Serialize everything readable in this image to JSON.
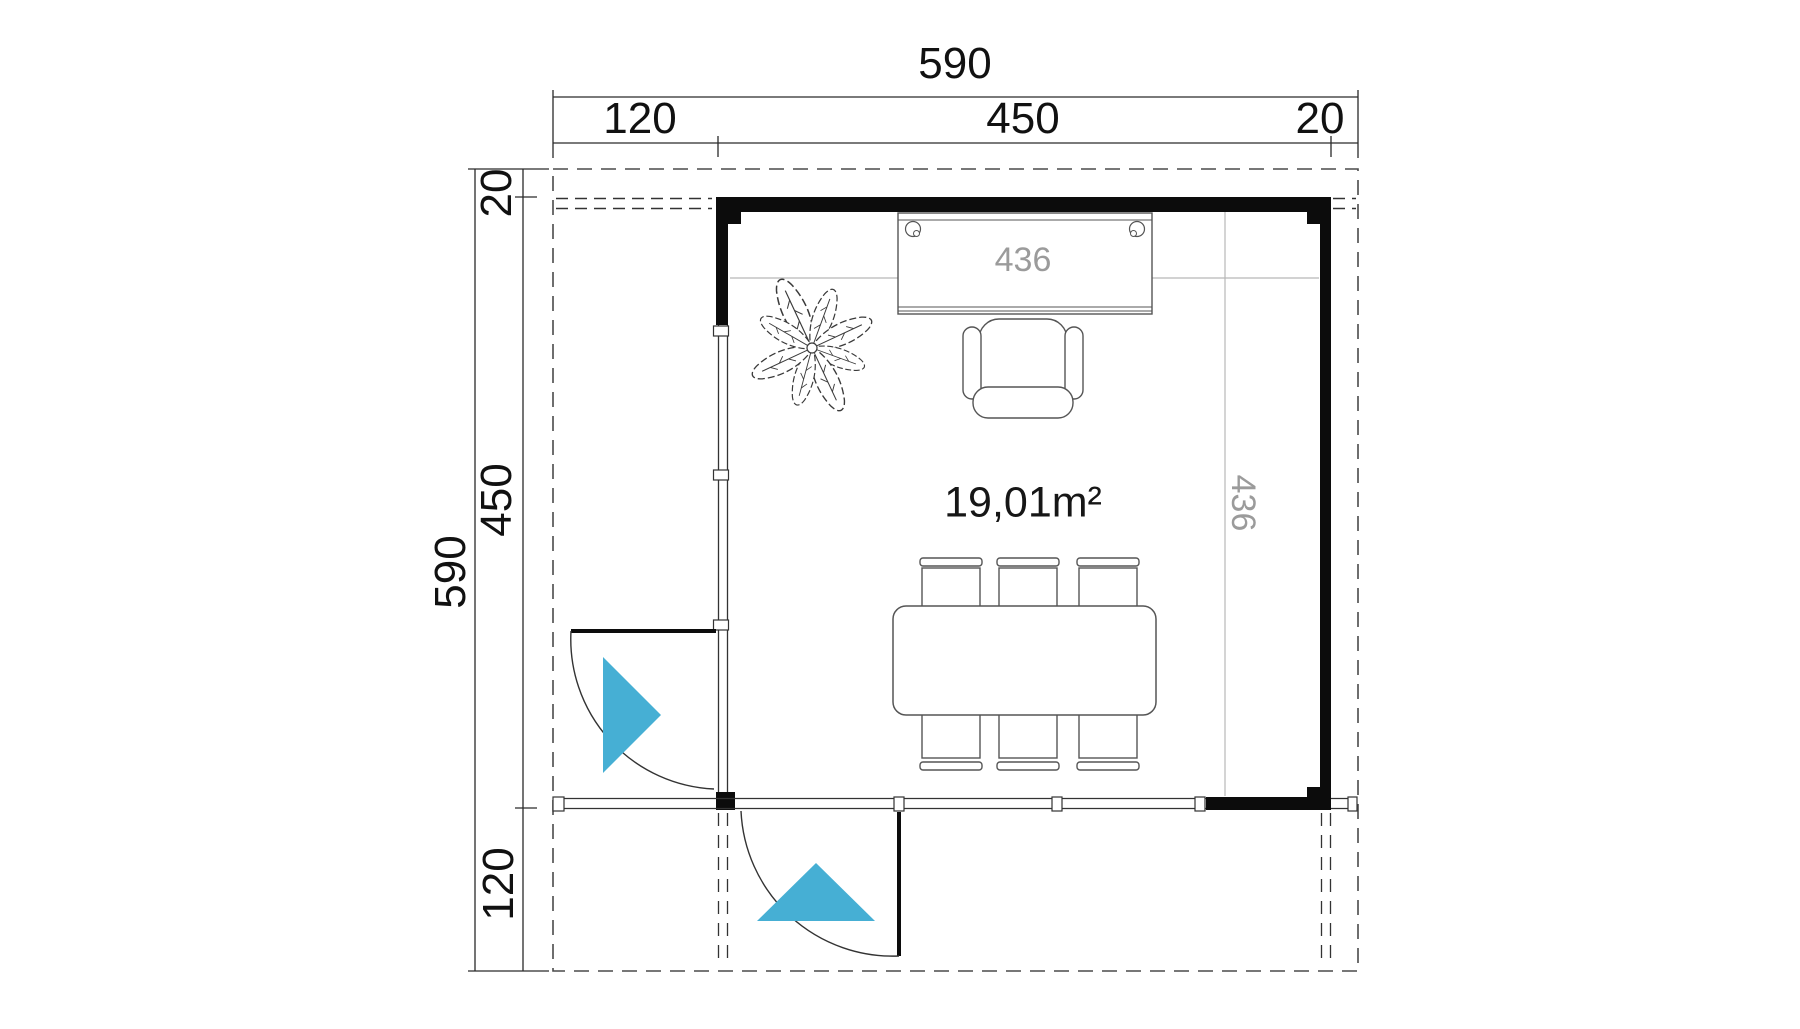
{
  "colors": {
    "accent": "#46AFD4",
    "wall_black": "#0c0c0c",
    "line_dark": "#333333",
    "dim_line_gray": "#b8b8b8",
    "dim_text_gray": "#9b9b9b"
  },
  "dimensions": {
    "top_total": "590",
    "top_segments": [
      "120",
      "450",
      "20"
    ],
    "left_total": "590",
    "left_segments": [
      "20",
      "450",
      "120"
    ],
    "interior_width": "436",
    "interior_height": "436"
  },
  "room": {
    "area_label": "19,01m²"
  }
}
